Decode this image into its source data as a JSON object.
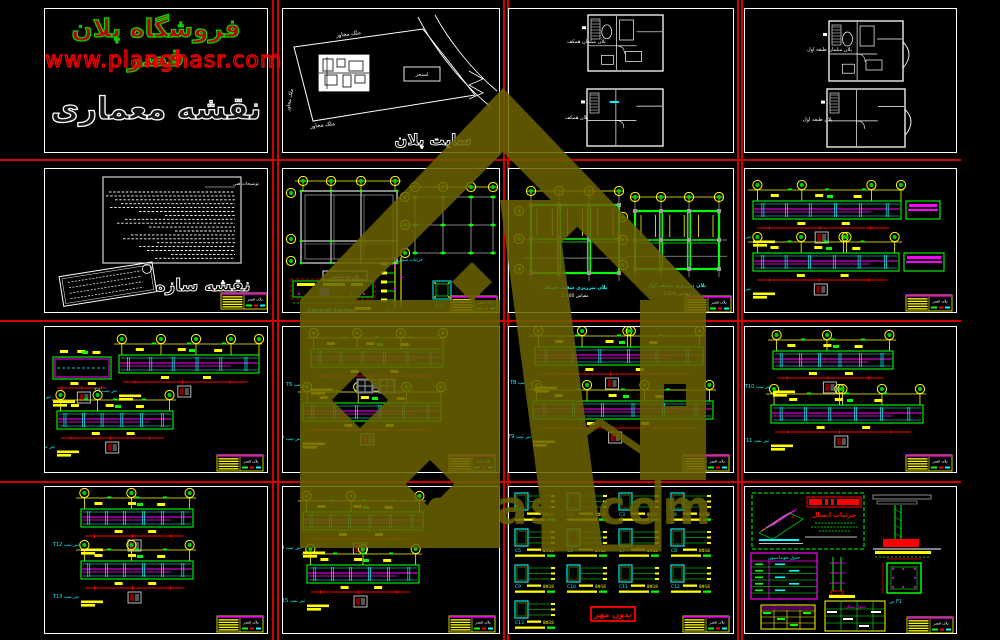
{
  "canvas": {
    "w": 1000,
    "h": 640,
    "bg": "#000000"
  },
  "palette": {
    "green": "#00ff00",
    "yellow": "#ffff00",
    "cyan": "#00ffff",
    "magenta": "#ff00ff",
    "red": "#ff0000",
    "white": "#ffffff",
    "gray": "#9c9c9c",
    "blue": "#2222ff",
    "watermark": "#6b6200",
    "separator": "#d40000"
  },
  "separators": {
    "vertical_x": [
      272,
      277,
      503,
      507,
      737,
      741
    ],
    "horizontal_y": [
      159,
      320,
      481
    ],
    "horizontal_extent": 961
  },
  "branding": {
    "title": "فروشگاه پلان قصر",
    "url": "www.planghasr.com",
    "subtitle": "نقشه معماری"
  },
  "watermark": {
    "text": "planghasr.com"
  },
  "title_block": {
    "name": "پلان قصر"
  },
  "site": {
    "neighbor_top": "ملک مجاور",
    "neighbor_bottom": "ملک مجاور",
    "neighbor_left": "ملک مجاور",
    "pool_label": "استخر",
    "caption": "سایت پلان"
  },
  "floors3": {
    "top_label": "پلان مبلمان همکف",
    "bottom_label": "پلان همکف"
  },
  "floors4": {
    "top_label": "پلان مبلمان طبقه اول",
    "bottom_label": "پلان طبقه اول"
  },
  "notes": {
    "header": "توضیحات فنی",
    "caption": "نقشه سازه"
  },
  "foundation": {
    "plan_label": "پلان فونداسیون",
    "section_caption": "General Section",
    "column_caption": "جزئیات ستون",
    "detail_caption": "1-1",
    "square_caption": "A-A"
  },
  "framing": {
    "plan1_caption": "پلان تیرریزی سقف همکف",
    "plan1_sub": "مقیاس 1:100",
    "plan2_caption": "پلان تیرریزی سقف اول",
    "plan2_sub": "مقیاس 1:100"
  },
  "strips_sub": "مقیاس 1:25",
  "columns": {
    "stamp": "بدون مهر",
    "bars_note": "8Φ18",
    "labels": [
      "C1",
      "C2",
      "C3",
      "C4",
      "C5",
      "C6",
      "C7",
      "C8",
      "C9",
      "C10",
      "C11",
      "C12",
      "C13"
    ]
  },
  "details": {
    "note_title": "جزئیات اتصال",
    "table_header": "جدول فونداسیون",
    "footing_label": "پی F1",
    "rebar_table_title": "جدول میلگرد"
  },
  "panels": [
    {
      "id": "p1",
      "name": "sheet-branding",
      "x": 44,
      "y": 8,
      "w": 224,
      "h": 145,
      "type": "branding"
    },
    {
      "id": "p2",
      "name": "sheet-site-plan",
      "x": 282,
      "y": 8,
      "w": 218,
      "h": 145,
      "type": "site"
    },
    {
      "id": "p3",
      "name": "sheet-floor-plans-ground",
      "x": 508,
      "y": 8,
      "w": 226,
      "h": 145,
      "type": "floors",
      "plans": [
        {
          "x": 79,
          "y": 6,
          "w": 75,
          "h": 56,
          "lx": 58,
          "ly": 34,
          "label_key": "floors3.top_label",
          "dense": true,
          "tick": false
        },
        {
          "x": 78,
          "y": 80,
          "w": 76,
          "h": 57,
          "lx": 56,
          "ly": 110,
          "label_key": "floors3.bottom_label",
          "dense": false,
          "tick": true
        }
      ]
    },
    {
      "id": "p4",
      "name": "sheet-floor-plans-first",
      "x": 744,
      "y": 8,
      "w": 213,
      "h": 145,
      "type": "floors",
      "plans": [
        {
          "x": 84,
          "y": 12,
          "w": 74,
          "h": 60,
          "lx": 62,
          "ly": 42,
          "label_key": "floors4.top_label",
          "dense": true,
          "tick": false,
          "bay": true
        },
        {
          "x": 82,
          "y": 80,
          "w": 78,
          "h": 58,
          "lx": 58,
          "ly": 112,
          "label_key": "floors4.bottom_label",
          "dense": false,
          "tick": false,
          "bay": true
        }
      ]
    },
    {
      "id": "p5",
      "name": "sheet-structure-notes",
      "x": 44,
      "y": 168,
      "w": 224,
      "h": 145,
      "type": "notes"
    },
    {
      "id": "p6",
      "name": "sheet-foundation",
      "x": 282,
      "y": 168,
      "w": 218,
      "h": 145,
      "type": "foundation"
    },
    {
      "id": "p7",
      "name": "sheet-framing",
      "x": 508,
      "y": 168,
      "w": 226,
      "h": 145,
      "type": "framing"
    },
    {
      "id": "p8",
      "name": "sheet-beams-1",
      "x": 744,
      "y": 168,
      "w": 213,
      "h": 145,
      "type": "strips",
      "strips": [
        {
          "x": 8,
          "y": 32,
          "w": 148,
          "bub": [
            0.03,
            0.33,
            0.8,
            1.0
          ],
          "tail": 34,
          "caption": "تیر تیپ T1"
        },
        {
          "x": 8,
          "y": 84,
          "w": 146,
          "bub": [
            0.03,
            0.33,
            0.62,
            0.64,
            0.97
          ],
          "tail": 40,
          "caption": "تیر تیپ T2"
        }
      ]
    },
    {
      "id": "p9",
      "name": "sheet-beams-2",
      "x": 44,
      "y": 326,
      "w": 224,
      "h": 147,
      "type": "strips",
      "strips": [
        {
          "x": 8,
          "y": 30,
          "w": 58,
          "bub": [],
          "box": true,
          "caption": "تیر تیپ T3"
        },
        {
          "x": 74,
          "y": 28,
          "w": 140,
          "bub": [
            0.02,
            0.3,
            0.55,
            0.8,
            1.0
          ],
          "caption": "تیر تیپ T4"
        },
        {
          "x": 12,
          "y": 84,
          "w": 116,
          "bub": [
            0.03,
            0.35,
            0.97
          ],
          "caption": "تیر تیپ T5"
        }
      ]
    },
    {
      "id": "p10",
      "name": "sheet-beams-3",
      "x": 282,
      "y": 326,
      "w": 218,
      "h": 147,
      "type": "strips",
      "gray_boxes": [
        [
          74,
          52
        ],
        [
          96,
          52
        ]
      ],
      "strips": [
        {
          "x": 28,
          "y": 22,
          "w": 132,
          "bub": [
            0.02,
            0.35,
            0.68,
            1.0
          ],
          "caption": "تیر تیپ T6"
        },
        {
          "x": 20,
          "y": 76,
          "w": 138,
          "bub": [
            0.03,
            0.4,
            0.75,
            1.0
          ],
          "caption": "تیر تیپ T7"
        }
      ]
    },
    {
      "id": "p11",
      "name": "sheet-beams-4",
      "x": 508,
      "y": 326,
      "w": 226,
      "h": 147,
      "type": "strips",
      "strips": [
        {
          "x": 26,
          "y": 20,
          "w": 168,
          "bub": [
            0.02,
            0.28,
            0.55,
            0.57,
            0.98
          ],
          "caption": "تیر تیپ T8"
        },
        {
          "x": 24,
          "y": 74,
          "w": 180,
          "bub": [
            0.02,
            0.3,
            0.62,
            0.98
          ],
          "caption": "تیر تیپ T9"
        }
      ]
    },
    {
      "id": "p12",
      "name": "sheet-beams-5",
      "x": 744,
      "y": 326,
      "w": 213,
      "h": 147,
      "type": "strips",
      "strips": [
        {
          "x": 28,
          "y": 24,
          "w": 120,
          "bub": [
            0.03,
            0.45,
            0.97
          ],
          "caption": "تیر تیپ T10"
        },
        {
          "x": 26,
          "y": 78,
          "w": 152,
          "bub": [
            0.02,
            0.45,
            0.47,
            0.73,
            0.98
          ],
          "caption": "تیر تیپ T11"
        }
      ]
    },
    {
      "id": "p13",
      "name": "sheet-beams-6",
      "x": 44,
      "y": 486,
      "w": 224,
      "h": 148,
      "type": "strips",
      "strips": [
        {
          "x": 36,
          "y": 22,
          "w": 112,
          "bub": [
            0.03,
            0.45,
            0.97
          ],
          "caption": "تیر تیپ T12"
        },
        {
          "x": 36,
          "y": 74,
          "w": 112,
          "bub": [
            0.03,
            0.45,
            0.97
          ],
          "caption": "تیر تیپ T13"
        }
      ]
    },
    {
      "id": "p14",
      "name": "sheet-beams-7",
      "x": 282,
      "y": 486,
      "w": 218,
      "h": 148,
      "type": "strips",
      "strips": [
        {
          "x": 20,
          "y": 25,
          "w": 120,
          "bub": [
            0.03,
            0.4,
            0.97
          ],
          "caption": "تیر تیپ T14"
        },
        {
          "x": 24,
          "y": 78,
          "w": 112,
          "bub": [
            0.03,
            0.5,
            0.97
          ],
          "caption": "تیر تیپ T15"
        }
      ]
    },
    {
      "id": "p15",
      "name": "sheet-column-sections",
      "x": 508,
      "y": 486,
      "w": 226,
      "h": 148,
      "type": "columns"
    },
    {
      "id": "p16",
      "name": "sheet-details",
      "x": 744,
      "y": 486,
      "w": 213,
      "h": 148,
      "type": "details"
    }
  ]
}
